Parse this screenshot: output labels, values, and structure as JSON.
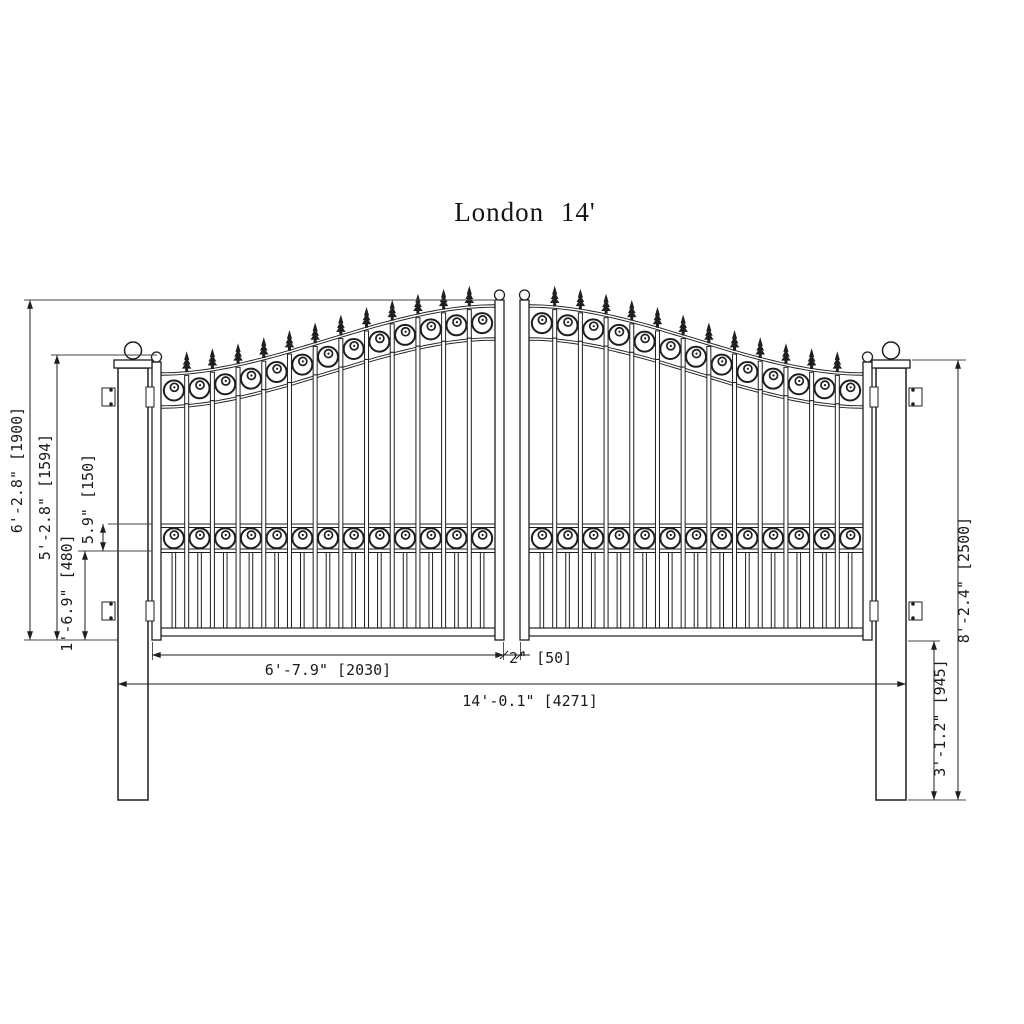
{
  "title": "London 14'",
  "drawing": {
    "type": "gate-dimension-drawing",
    "product": "London",
    "nominal_width_ft": "14'"
  },
  "dimensions": {
    "total_height": "6'-2.8\" [1900]",
    "leaf_height": "5'-2.8\" [1594]",
    "lower_section": "1'-6.9\" [480]",
    "band_height": "5.9\" [150]",
    "post_height": "8'-2.4\" [2500]",
    "post_lower": "3'-1.2\" [945]",
    "leaf_width": "6'-7.9\" [2030]",
    "gap": "2\" [50]",
    "total_width": "14'-0.1\" [4271]"
  },
  "colors": {
    "ink": "#1f1f1f",
    "thin_line": "#444444",
    "background": "#ffffff"
  }
}
